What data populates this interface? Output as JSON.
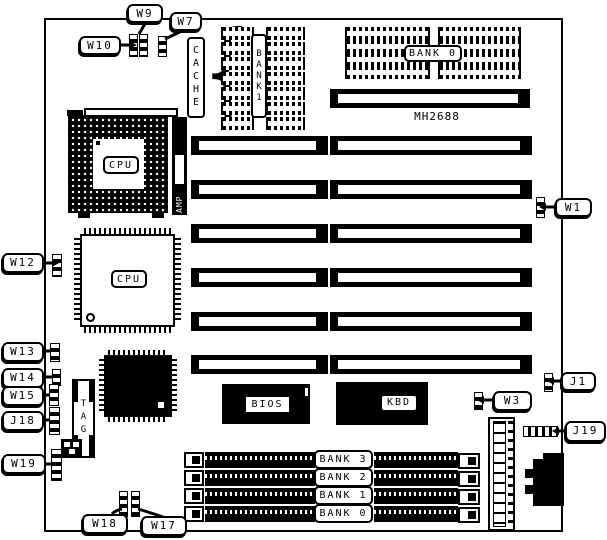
{
  "board": {
    "model": "MH2688"
  },
  "callouts": {
    "w9": "W9",
    "w7": "W7",
    "w10": "W10",
    "w12": "W12",
    "w13": "W13",
    "w14": "W14",
    "w15": "W15",
    "j18": "J18",
    "w19": "W19",
    "w18": "W18",
    "w17": "W17",
    "w1": "W1",
    "j1": "J1",
    "w3": "W3",
    "j19": "J19"
  },
  "chips": {
    "cache_label": "CACHE",
    "cache_bank_label": "BANK1",
    "top_bank_label": "BANK 0",
    "cpu_socket_label": "CPU",
    "cpu_qfp_label": "CPU",
    "amp_label": "AMP",
    "tag_label": "TAG",
    "bios_label": "BIOS",
    "kbd_label": "KBD"
  },
  "simm": {
    "banks": [
      "BANK 3",
      "BANK 2",
      "BANK 1",
      "BANK 0"
    ]
  },
  "colors": {
    "ink": "#000000",
    "paper": "#ffffff"
  }
}
